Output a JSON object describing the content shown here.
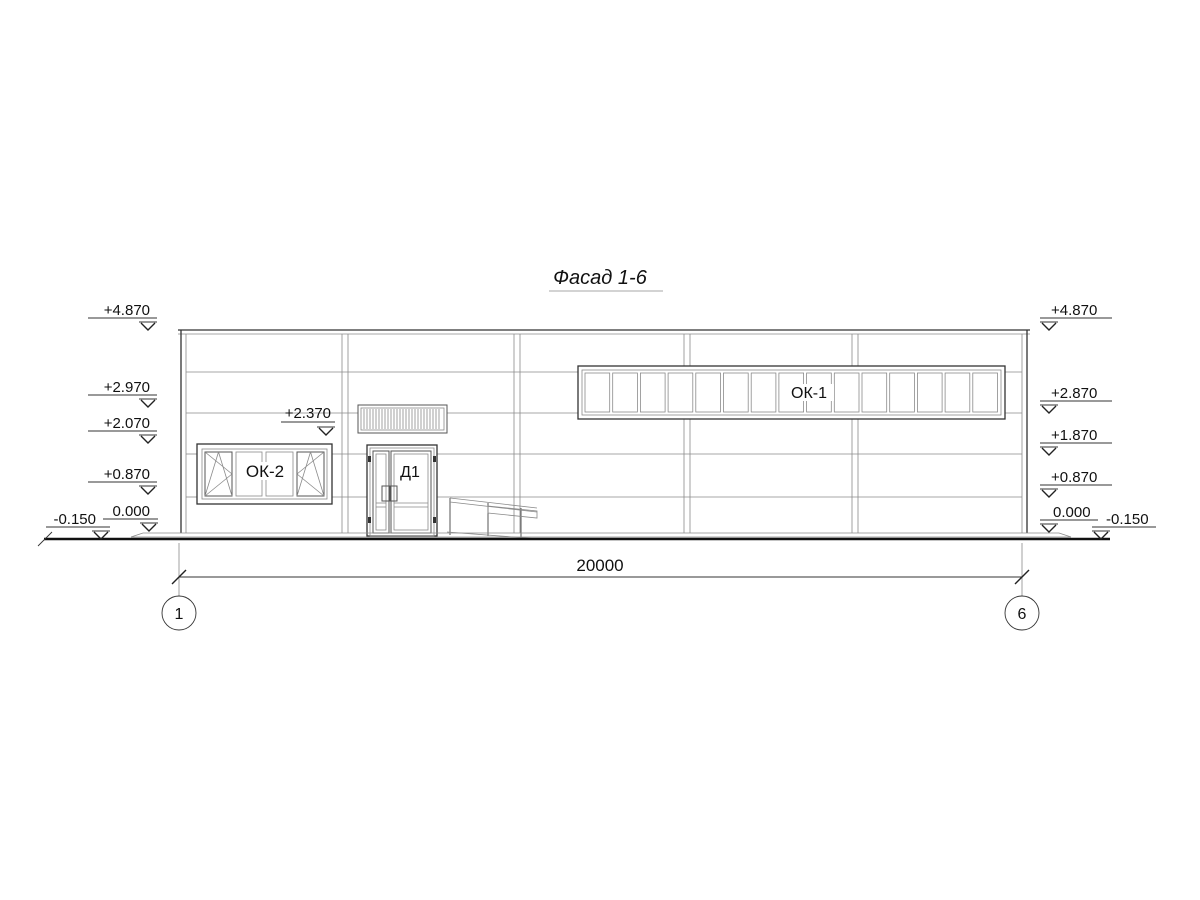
{
  "title": {
    "text": "Фасад 1-6"
  },
  "elevations": {
    "left": [
      "+4.870",
      "+2.970",
      "+2.070",
      "+0.870",
      "0.000",
      "-0.150"
    ],
    "right": [
      "+4.870",
      "+2.870",
      "+1.870",
      "+0.870",
      "0.000",
      "-0.150"
    ],
    "canopy": "+2.370"
  },
  "labels": {
    "ribbon_window": "ОК-1",
    "left_window": "ОК-2",
    "door": "Д1"
  },
  "dimension": {
    "total": "20000"
  },
  "axes": {
    "left": "1",
    "right": "6"
  },
  "colors": {
    "outline": "#333333",
    "seam": "#8a8a8a",
    "ground": "#111111",
    "text": "#111111"
  }
}
